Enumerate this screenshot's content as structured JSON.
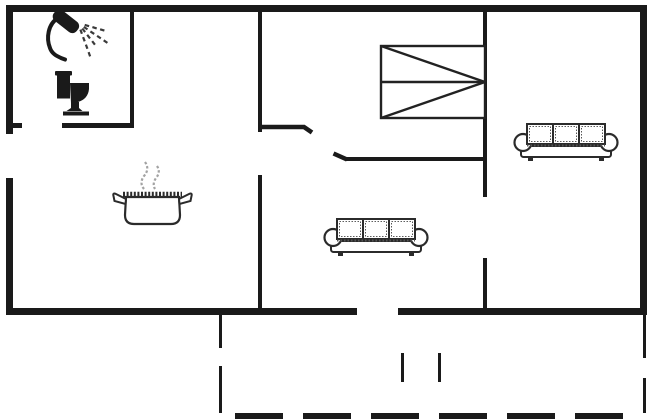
{
  "meta": {
    "title": "holiday-home-floor-plan",
    "canvas": {
      "width": 650,
      "height": 420
    },
    "colors": {
      "background": "#ffffff",
      "wall": "#1a1a1a",
      "furniture_stroke": "#2b2b2b",
      "furniture_fill": "#ffffff",
      "fixture_fill": "#1a1a1a",
      "steam": "#a3a3a3",
      "spray": "#3a3a3a"
    }
  },
  "floor_plan": {
    "walls": [
      {
        "name": "top-wall",
        "x": 6,
        "y": 5,
        "w": 641,
        "h": 7
      },
      {
        "name": "left-wall-upper",
        "x": 6,
        "y": 5,
        "w": 7,
        "h": 129
      },
      {
        "name": "left-wall-lower",
        "x": 6,
        "y": 178,
        "w": 7,
        "h": 137
      },
      {
        "name": "right-wall",
        "x": 640,
        "y": 5,
        "w": 7,
        "h": 310
      },
      {
        "name": "bottom-wall-left",
        "x": 6,
        "y": 308,
        "w": 351,
        "h": 7
      },
      {
        "name": "bottom-wall-right",
        "x": 398,
        "y": 308,
        "w": 249,
        "h": 7
      },
      {
        "name": "bathroom-right-wall",
        "x": 130,
        "y": 5,
        "w": 4,
        "h": 122
      },
      {
        "name": "bathroom-bottom-stub",
        "x": 6,
        "y": 123,
        "w": 16,
        "h": 5
      },
      {
        "name": "bathroom-bottom-wall",
        "x": 62,
        "y": 123,
        "w": 72,
        "h": 5
      },
      {
        "name": "kitchen-divider-upper",
        "x": 258,
        "y": 5,
        "w": 4,
        "h": 127
      },
      {
        "name": "kitchen-divider-lower",
        "x": 258,
        "y": 175,
        "w": 4,
        "h": 133
      },
      {
        "name": "bedroom-bottom-wall",
        "x": 345,
        "y": 157,
        "w": 142,
        "h": 4
      },
      {
        "name": "livingroom-divider-upper",
        "x": 483,
        "y": 5,
        "w": 4,
        "h": 192
      },
      {
        "name": "livingroom-divider-lower",
        "x": 483,
        "y": 258,
        "w": 4,
        "h": 50
      }
    ],
    "door_leaves": [
      {
        "name": "hallway-door-leaf",
        "points": [
          [
            262,
            127
          ],
          [
            304,
            127
          ],
          [
            312,
            132.5
          ]
        ],
        "width": 4.5
      },
      {
        "name": "bedroom-door-leaf",
        "points": [
          [
            333.5,
            153.5
          ],
          [
            347,
            159.5
          ]
        ],
        "width": 4.5
      }
    ],
    "terrace_dashes": [
      {
        "name": "terrace-edge-left-dash",
        "x": 219,
        "y": 315,
        "w": 3,
        "h": 33
      },
      {
        "name": "terrace-edge-left-dash",
        "x": 219,
        "y": 366,
        "w": 3,
        "h": 47
      },
      {
        "name": "terrace-edge-right-dash",
        "x": 643,
        "y": 315,
        "w": 3,
        "h": 43
      },
      {
        "name": "terrace-edge-right-dash",
        "x": 643,
        "y": 378,
        "w": 3,
        "h": 35
      },
      {
        "name": "terrace-step-dash",
        "x": 401,
        "y": 353,
        "w": 3,
        "h": 29
      },
      {
        "name": "terrace-step-dash",
        "x": 438,
        "y": 353,
        "w": 3,
        "h": 29
      },
      {
        "name": "terrace-edge-bottom-dash",
        "x": 235,
        "y": 413,
        "w": 48,
        "h": 6
      },
      {
        "name": "terrace-edge-bottom-dash",
        "x": 303,
        "y": 413,
        "w": 48,
        "h": 6
      },
      {
        "name": "terrace-edge-bottom-dash",
        "x": 371,
        "y": 413,
        "w": 48,
        "h": 6
      },
      {
        "name": "terrace-edge-bottom-dash",
        "x": 439,
        "y": 413,
        "w": 48,
        "h": 6
      },
      {
        "name": "terrace-edge-bottom-dash",
        "x": 507,
        "y": 413,
        "w": 48,
        "h": 6
      },
      {
        "name": "terrace-edge-bottom-dash",
        "x": 575,
        "y": 413,
        "w": 48,
        "h": 6
      }
    ],
    "furniture": [
      {
        "icon": "shower-icon",
        "type": "shower",
        "x": 44,
        "y": 10
      },
      {
        "icon": "toilet-icon",
        "type": "toilet",
        "x": 52,
        "y": 70
      },
      {
        "icon": "cooking-pot-icon",
        "type": "pot",
        "x": 112,
        "y": 158
      },
      {
        "icon": "double-bed-icon",
        "type": "bed",
        "x": 381,
        "y": 46,
        "w": 104,
        "h": 72
      },
      {
        "icon": "sofa-icon",
        "type": "sofa",
        "x": 513,
        "y": 121
      },
      {
        "icon": "sofa-icon",
        "type": "sofa",
        "x": 323,
        "y": 216
      }
    ]
  }
}
